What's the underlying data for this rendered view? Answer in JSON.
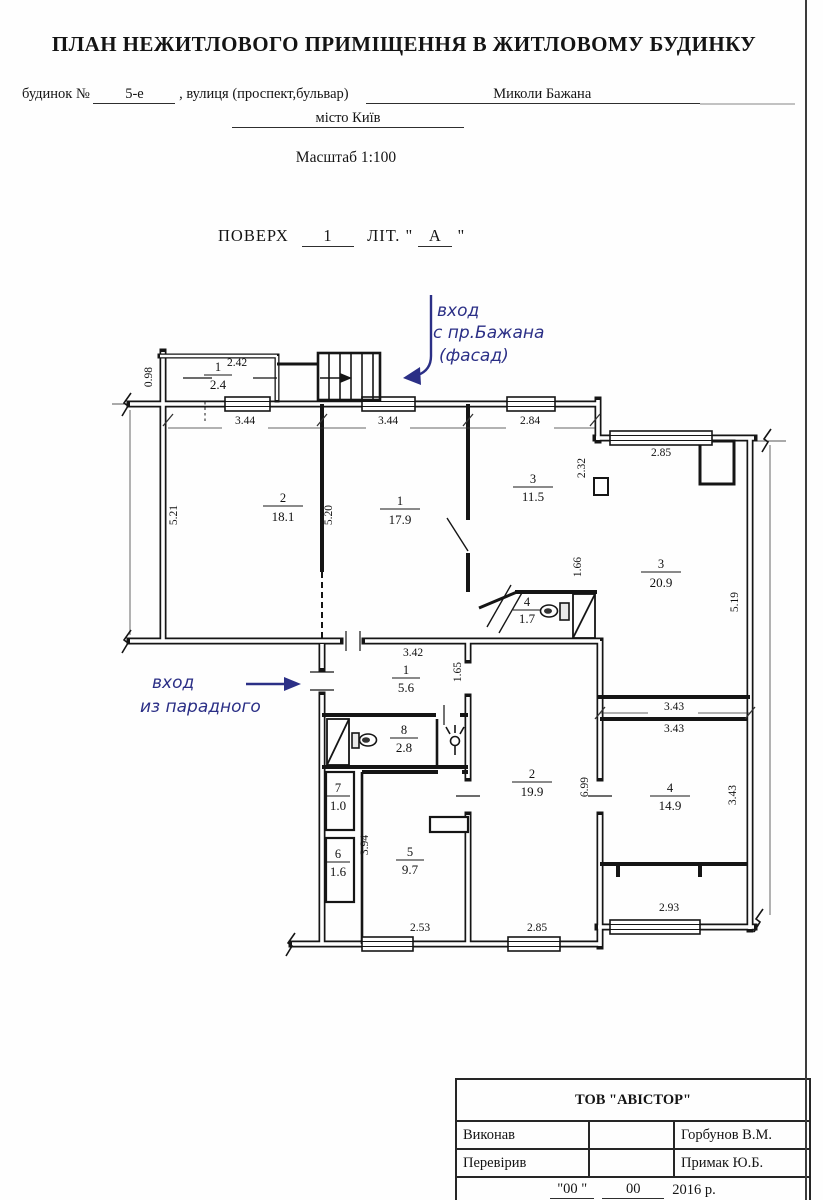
{
  "header": {
    "title": "ПЛАН НЕЖИТЛОВОГО ПРИМІЩЕННЯ В ЖИТЛОВОМУ БУДИНКУ",
    "building_label": "будинок №",
    "building_value": "5-е",
    "street_label": ", вулиця (проспект,бульвар)",
    "street_value": "Миколи Бажана",
    "city": "місто Київ",
    "scale": "Масштаб 1:100",
    "floor_label": "ПОВЕРХ",
    "floor_value": "1",
    "letter_prefix": "ЛІТ. \"",
    "letter_value": "А",
    "letter_suffix": "\""
  },
  "plan": {
    "rooms": [
      {
        "num": "1",
        "area": "2.4"
      },
      {
        "num": "2",
        "area": "18.1"
      },
      {
        "num": "1",
        "area": "17.9"
      },
      {
        "num": "3",
        "area": "11.5"
      },
      {
        "num": "4",
        "area": "1.7"
      },
      {
        "num": "3",
        "area": "20.9"
      },
      {
        "num": "1",
        "area": "5.6"
      },
      {
        "num": "8",
        "area": "2.8"
      },
      {
        "num": "7",
        "area": "1.0"
      },
      {
        "num": "6",
        "area": "1.6"
      },
      {
        "num": "5",
        "area": "9.7"
      },
      {
        "num": "2",
        "area": "19.9"
      },
      {
        "num": "4",
        "area": "14.9"
      }
    ],
    "dims": [
      "2.42",
      "0.98",
      "3.44",
      "3.44",
      "2.84",
      "2.85",
      "2.32",
      "5.21",
      "5.20",
      "1.66",
      "5.19",
      "3.42",
      "1.65",
      "3.43",
      "3.43",
      "3.43",
      "6.99",
      "3.94",
      "2.53",
      "2.85",
      "2.93"
    ],
    "annotations": {
      "top": [
        "вход",
        "с пр.Бажана",
        "(фасад)"
      ],
      "left": [
        "вход",
        "из парадного"
      ]
    },
    "fixtures": [
      "stairs",
      "toilet",
      "toilet",
      "lamp",
      "wardrobe",
      "vent-shaft"
    ]
  },
  "title_block": {
    "company": "ТОВ \"АВІСТОР\"",
    "executed_label": "Виконав",
    "executed_value": "Горбунов В.М.",
    "checked_label": "Перевірив",
    "checked_value": "Примак Ю.Б.",
    "date_day_quoted": "\"00 \"",
    "date_month": "00",
    "date_year": "2016 р."
  }
}
